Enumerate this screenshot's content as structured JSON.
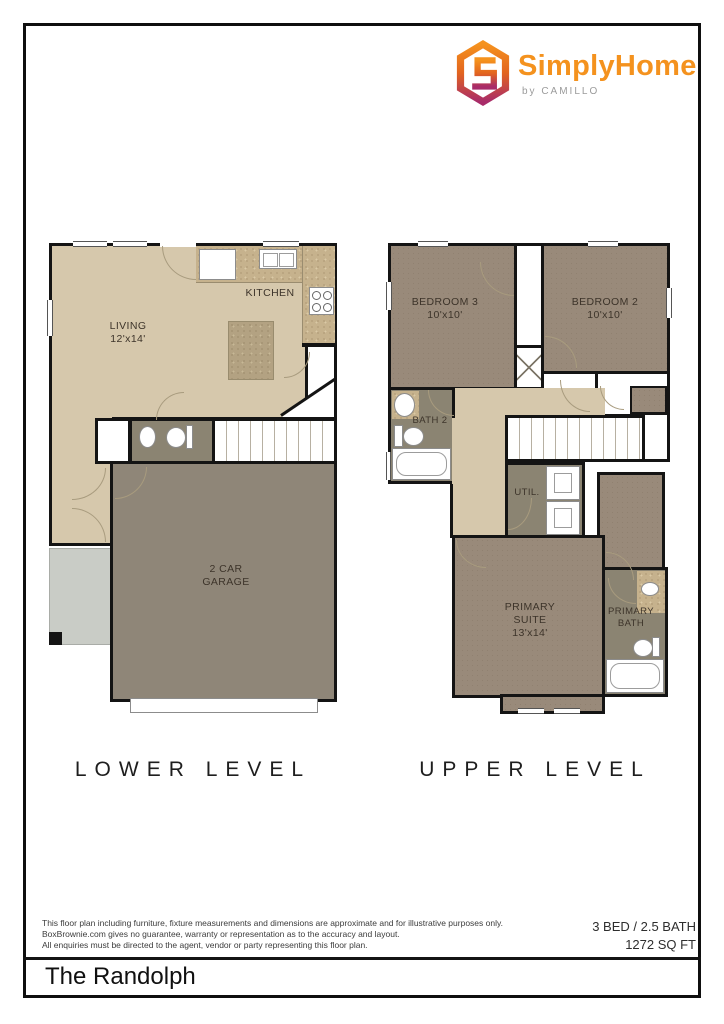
{
  "logo": {
    "brand": "SimplyHome",
    "tagline": "by CAMILLO",
    "colors": {
      "orange": "#F4921E",
      "magenta": "#A82B69",
      "tagline_gray": "#9B9B9B"
    }
  },
  "lower_level": {
    "label": "LOWER LEVEL",
    "rooms": {
      "living": "LIVING\n12'x14'",
      "kitchen": "KITCHEN",
      "garage": "2 CAR\nGARAGE"
    }
  },
  "upper_level": {
    "label": "UPPER LEVEL",
    "rooms": {
      "bedroom3": "BEDROOM 3\n10'x10'",
      "bedroom2": "BEDROOM 2\n10'x10'",
      "bath2": "BATH 2",
      "util": "UTIL.",
      "primary_suite": "PRIMARY\nSUITE\n13'x14'",
      "primary_bath": "PRIMARY\nBATH"
    }
  },
  "footer": {
    "disclaimer": [
      "This floor plan including furniture, fixture measurements and dimensions are approximate and for illustrative purposes only.",
      "BoxBrownie.com gives no guarantee, warranty or representation as to the accuracy and layout.",
      "All enquiries must be directed to the agent, vendor or party representing this floor plan."
    ],
    "specs": [
      "3 BED / 2.5 BATH",
      "1272 SQ FT"
    ],
    "plan_title": "The Randolph"
  }
}
